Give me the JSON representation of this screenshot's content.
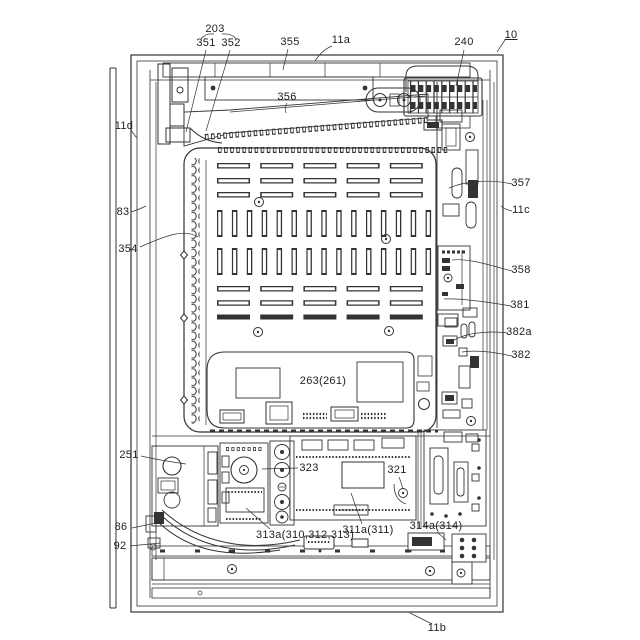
{
  "figure": {
    "type": "patent line drawing",
    "background": "#ffffff",
    "line_color": "#333333"
  },
  "labels": {
    "n203": "203",
    "n351": "351",
    "n352": "352",
    "n355": "355",
    "n356": "356",
    "n11a": "11a",
    "n240": "240",
    "n10": "10",
    "n11d": "11d",
    "n83": "83",
    "n354": "354",
    "n357": "357",
    "n11c": "11c",
    "n358": "358",
    "n381": "381",
    "n382a": "382a",
    "n382": "382",
    "n251": "251",
    "n263": "263(261)",
    "n323": "323",
    "n321": "321",
    "n86": "86",
    "n92": "92",
    "n313a": "313a(310,312,313)",
    "n311a": "311a(311)",
    "n314a": "314a(314)",
    "n11b": "11b"
  }
}
